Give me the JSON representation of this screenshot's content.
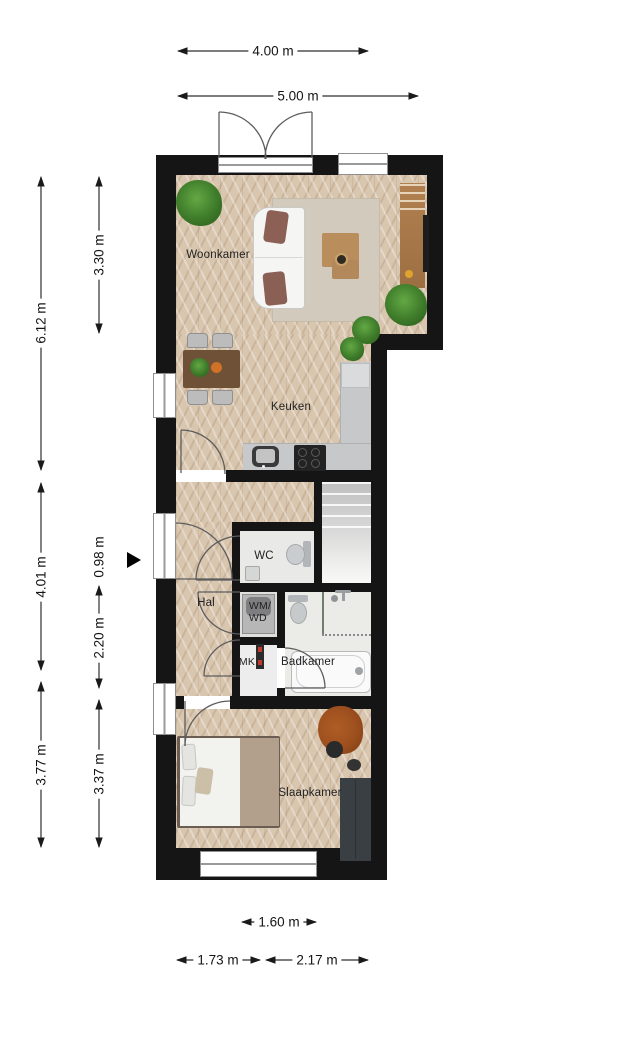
{
  "rooms": {
    "woonkamer": "Woonkamer",
    "keuken": "Keuken",
    "hal": "Hal",
    "wc": "WC",
    "wmwd_top": "WM/",
    "wmwd_bottom": "WD",
    "mk": "MK",
    "badkamer": "Badkamer",
    "slaapkamer": "Slaapkamer"
  },
  "dims": {
    "top_inner": "4.00 m",
    "top_outer": "5.00 m",
    "left_upper_total": "6.12 m",
    "left_woonkamer": "3.30 m",
    "left_mid_total": "4.01 m",
    "left_small": "0.98 m",
    "left_hal": "2.20 m",
    "left_lower_total": "3.77 m",
    "left_slaapkamer": "3.37 m",
    "bottom_window": "1.60 m",
    "bottom_left": "1.73 m",
    "bottom_right": "2.17 m"
  },
  "colors": {
    "wall": "#151515",
    "wood_floor": "#d9c6af",
    "bath_floor": "#ebebe8",
    "counter": "#c6c8ca",
    "rug": "#d2cabc",
    "wardrobe": "#3a3f43",
    "armchair_rust": "#9c4f1e",
    "plant_green": "#3e7b2a",
    "cabinet_wood": "#b28050"
  },
  "icons": {
    "entrance": "triangle-right-icon"
  }
}
